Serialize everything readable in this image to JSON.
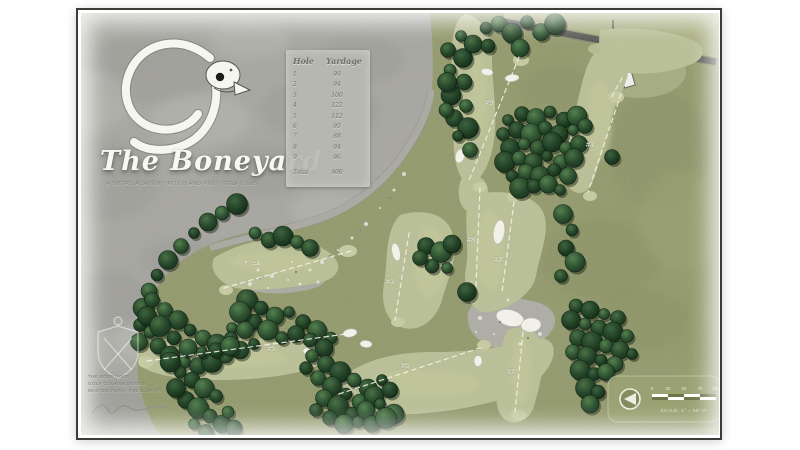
{
  "poster": {
    "title": "The Boneyard",
    "subtitle": "A SHORT ACADEMY PITCH AND PUTT GOLF CLUB"
  },
  "yardage_table": {
    "col_hole": "Hole",
    "col_yardage": "Yardage",
    "rows": [
      [
        "1",
        "99"
      ],
      [
        "2",
        "94"
      ],
      [
        "3",
        "100"
      ],
      [
        "4",
        "122"
      ],
      [
        "5",
        "112"
      ],
      [
        "6",
        "95"
      ],
      [
        "7",
        "88"
      ],
      [
        "8",
        "94"
      ],
      [
        "9",
        "96"
      ]
    ],
    "total_label": "Total",
    "total_value": "900"
  },
  "holes": [
    {
      "label": "#1"
    },
    {
      "label": "#2"
    },
    {
      "label": "#3"
    },
    {
      "label": "#4"
    },
    {
      "label": "#5"
    },
    {
      "label": "#6"
    },
    {
      "label": "#7"
    },
    {
      "label": "#8"
    },
    {
      "label": "#9"
    }
  ],
  "credits": {
    "line1": "THE BONEYARD",
    "line2": "GOLF COURSE DESIGN",
    "line3": "MASTER PLAN · FINAL DRAFT"
  },
  "legend": {
    "scale_ticks": [
      "0",
      "25",
      "50",
      "75",
      "100"
    ],
    "scale_caption": "SCALE: 1\" = 50'-0\""
  },
  "colors": {
    "rough_gray": "#a2a19b",
    "turf_olive": "#8d9464",
    "fairway_light": "#b6bc90",
    "green_light": "#c6cb9f",
    "tree_dark": "#1f3b24",
    "bunker_white": "#f2f2ea",
    "road_gray": "#4c4c48"
  }
}
